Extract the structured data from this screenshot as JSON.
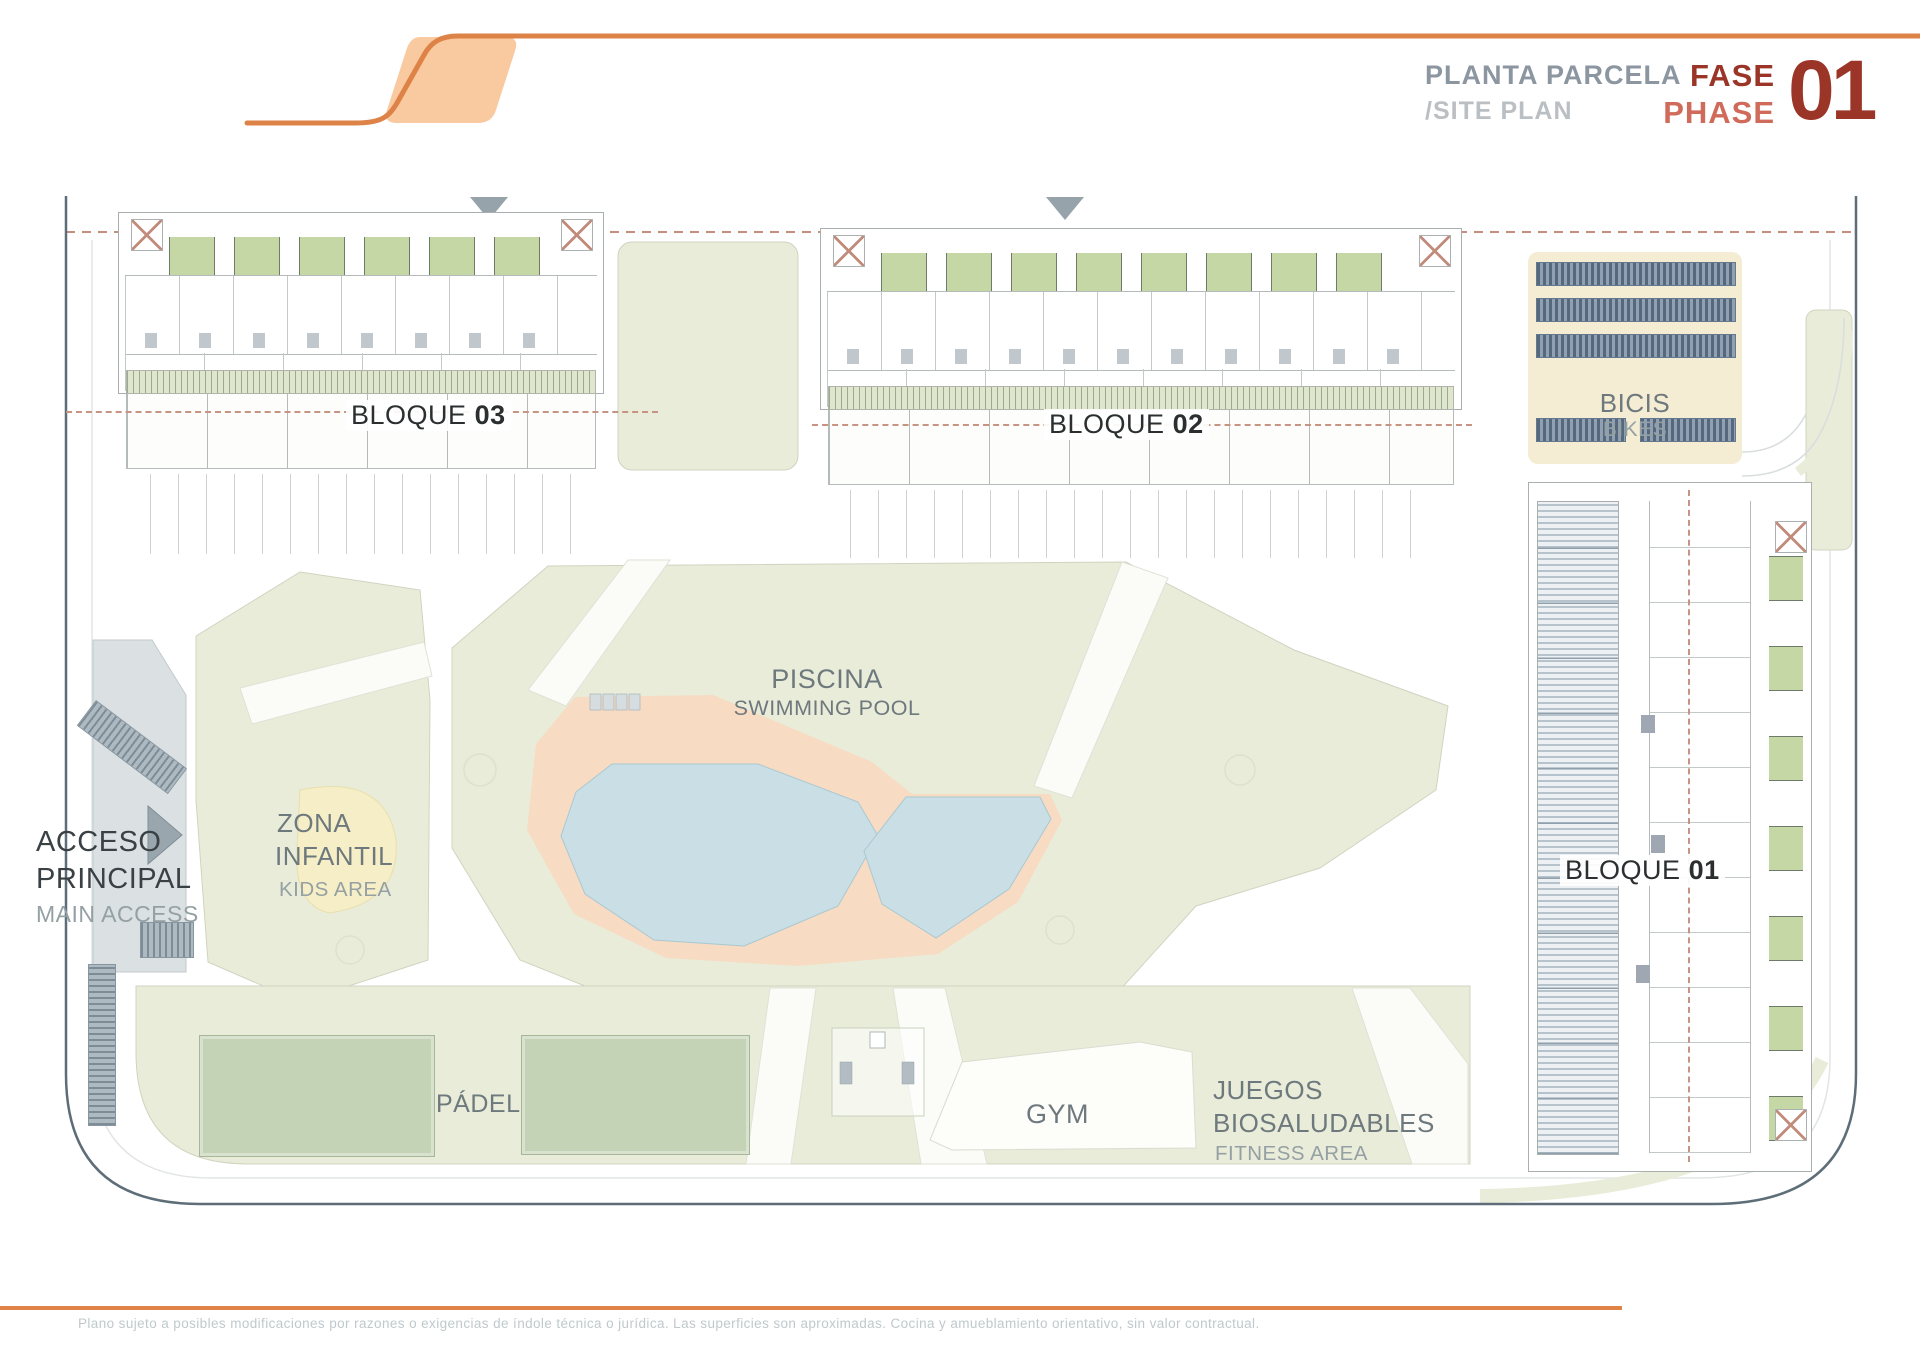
{
  "header": {
    "title_es": "PLANTA PARCELA",
    "title_en": "/SITE PLAN",
    "fase": "FASE",
    "phase": "PHASE",
    "phase_number": "01"
  },
  "plan": {
    "bloques": [
      {
        "prefix": "BLOQUE",
        "num": "01"
      },
      {
        "prefix": "BLOQUE",
        "num": "02"
      },
      {
        "prefix": "BLOQUE",
        "num": "03"
      }
    ],
    "bikes": {
      "es": "BICIS",
      "en": "BIKES"
    },
    "pool": {
      "es": "PISCINA",
      "en": "SWIMMING POOL"
    },
    "kids": {
      "es_line1": "ZONA",
      "es_line2": "INFANTIL",
      "en": "KIDS AREA"
    },
    "access": {
      "es_line1": "ACCESO",
      "es_line2": "PRINCIPAL",
      "en": "MAIN ACCESS"
    },
    "padel": "PÁDEL",
    "gym": "GYM",
    "fitness": {
      "es_line1": "JUEGOS",
      "es_line2": "BIOSALUDABLES",
      "en": "FITNESS AREA"
    }
  },
  "footer": {
    "disclaimer": "Plano sujeto a posibles modificaciones por razones o exigencias de índole técnica o jurídica. Las superficies son aproximadas. Cocina y amueblamiento orientativo, sin valor contractual."
  },
  "colors": {
    "accent_orange": "#E08348",
    "logo_fill": "#F9C9A0",
    "phase_dark": "#9A3527",
    "phase_light": "#D06B5B",
    "title_gray": "#8C96A0",
    "park_green": "#E9ECD8",
    "pool_blue": "#C9DFE5",
    "deck_peach": "#F7DBC3",
    "court_green": "#C4D3B5",
    "boundary_slate": "#5E6E78",
    "dashed_line": "#C79484"
  }
}
